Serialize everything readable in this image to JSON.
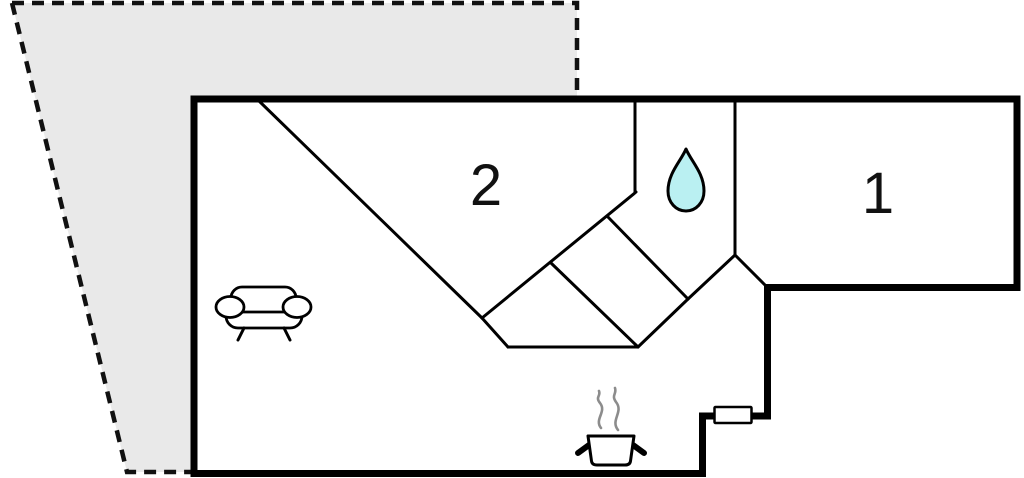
{
  "plan": {
    "type": "floor-plan",
    "rooms": [
      {
        "id": "room-2",
        "label": "2"
      },
      {
        "id": "room-1",
        "label": "1"
      }
    ],
    "icons": {
      "bathroom": "water-drop-icon",
      "living_area": "sofa-icon",
      "kitchen": "cooking-pot-icon",
      "terrace": "dashed-terrace-outline",
      "window": "window-marker"
    },
    "colors": {
      "wall": "#000000",
      "terrace_fill": "#e9e9e9",
      "water_drop_fill": "#baf0f2",
      "steam": "#8c8c8c",
      "window_fill": "#ffffff",
      "background": "#ffffff"
    }
  }
}
